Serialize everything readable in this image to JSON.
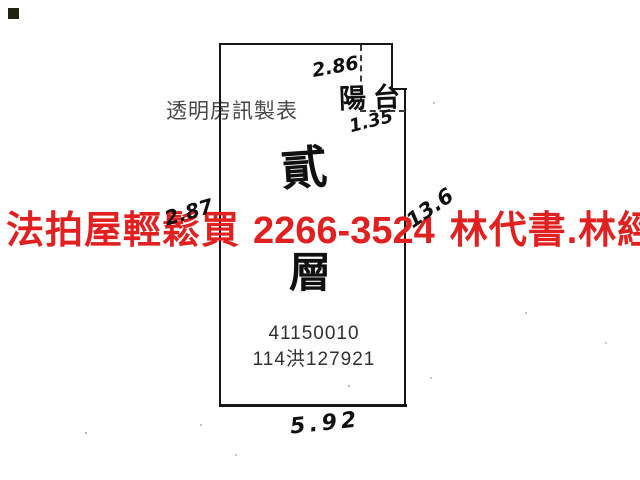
{
  "canvas": {
    "background": "#ffffff",
    "line_color": "#161616"
  },
  "corner_marker_color": "#20240f",
  "watermark": {
    "label": "透明房訊製表"
  },
  "overlay_ad": {
    "brand": "法拍屋輕鬆買",
    "phone": "2266-3524",
    "contact": "林代書.林經理",
    "color": "#e22020"
  },
  "floor_plan": {
    "floor_label_char1": "貳",
    "floor_label_char2": "層",
    "case_number": "41150010",
    "case_reference": "114洪127921",
    "balcony_label": "陽台",
    "dimensions": {
      "top_width": "2.86",
      "balcony_depth": "1.35",
      "left_partial": "2.87",
      "right_height": "13.6",
      "bottom_width": "5.92"
    }
  }
}
